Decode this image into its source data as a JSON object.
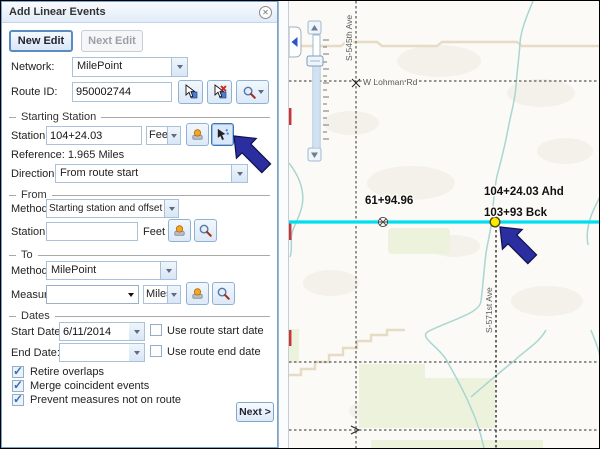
{
  "panel": {
    "title": "Add Linear Events",
    "buttons": {
      "new_edit": "New Edit",
      "next_edit": "Next Edit",
      "next": "Next >"
    },
    "network": {
      "label": "Network:",
      "value": "MilePoint"
    },
    "route_id": {
      "label": "Route ID:",
      "value": "950002744"
    },
    "sections": {
      "starting_station": "Starting Station",
      "from": "From",
      "to": "To",
      "dates": "Dates"
    },
    "starting_station": {
      "station_label": "Station:",
      "station_value": "104+24.03",
      "unit": "Feet",
      "reference": "Reference: 1.965 Miles",
      "direction_label": "Direction:",
      "direction_value": "From route start"
    },
    "from": {
      "method_label": "Method:",
      "method_value": "Starting station and offset",
      "station_label": "Station:",
      "station_value": "",
      "unit": "Feet"
    },
    "to": {
      "method_label": "Method:",
      "method_value": "MilePoint",
      "measure_label": "Measure:",
      "measure_value": "",
      "unit": "Miles"
    },
    "dates": {
      "start_label": "Start Date:",
      "start_value": "6/11/2014",
      "start_checkbox": "Use route start date",
      "end_label": "End Date:",
      "end_value": "",
      "end_checkbox": "Use route end date"
    },
    "options": [
      "Retire overlaps",
      "Merge coincident events",
      "Prevent measures not on route"
    ]
  },
  "map": {
    "road_labels": {
      "horizontal_road": "W Lohman Rd",
      "vertical_road_left": "S-545th Ave",
      "vertical_road_right": "S-571st Ave"
    },
    "station_labels": {
      "left_point": "61+94.96",
      "ahead": "104+24.03 Ahd",
      "back": "103+93 Bck"
    },
    "colors": {
      "route": "#00dff0",
      "marker_yellow": "#ffe800",
      "arrow": "#2b2e9e",
      "stream": "#a9d6d2",
      "field": "#edf2dd",
      "road_beige": "#e6dcc6"
    }
  }
}
